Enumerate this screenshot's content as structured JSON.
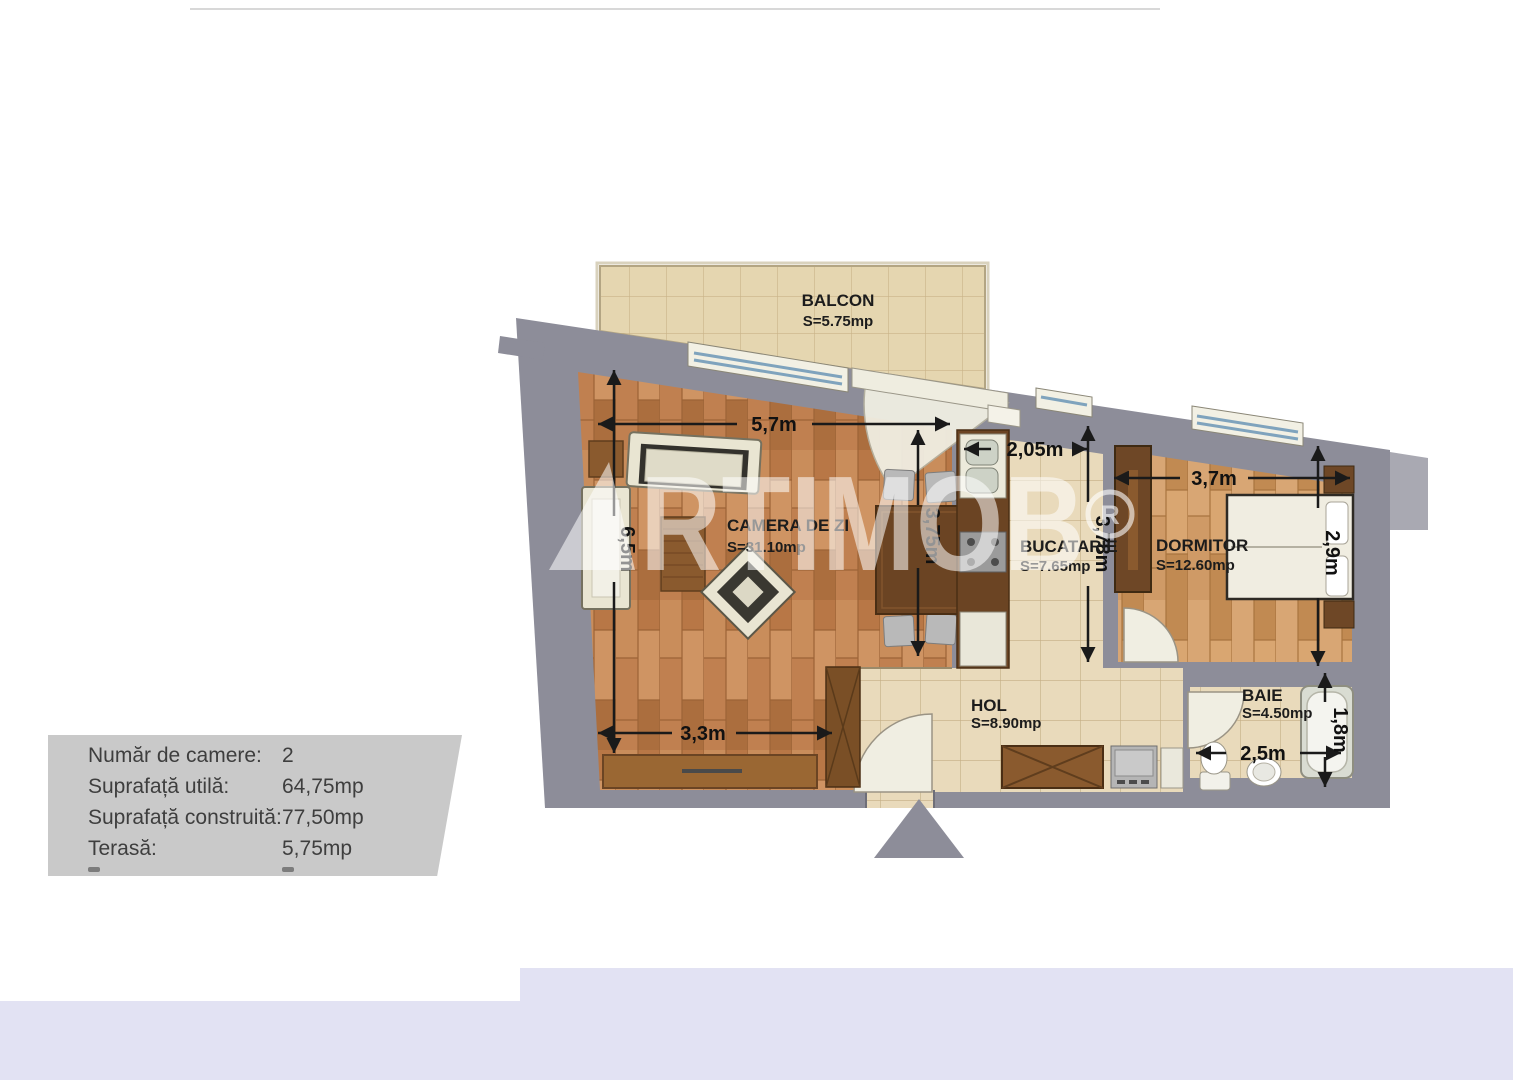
{
  "info_panel": {
    "rows": [
      {
        "label": "Număr de camere:",
        "value": "2"
      },
      {
        "label": "Suprafață utilă:",
        "value": "64,75mp"
      },
      {
        "label": "Suprafață construită:",
        "value": "77,50mp"
      },
      {
        "label": "Terasă:",
        "value": "5,75mp"
      }
    ]
  },
  "rooms": {
    "balcon": {
      "name": "BALCON",
      "area": "S=5.75mp"
    },
    "camera_de_zi": {
      "name": "CAMERA DE ZI",
      "area": "S=31.10mp"
    },
    "bucatarie": {
      "name": "BUCATARIE",
      "area": "S=7.65mp"
    },
    "dormitor": {
      "name": "DORMITOR",
      "area": "S=12.60mp"
    },
    "hol": {
      "name": "HOL",
      "area": "S=8.90mp"
    },
    "baie": {
      "name": "BAIE",
      "area": "S=4.50mp"
    }
  },
  "dimensions": {
    "living_width": "5,7m",
    "living_height": "6,5m",
    "living_inner_depth": "3,75m",
    "living_bottom_width": "3,3m",
    "kitchen_width": "2,05m",
    "kitchen_depth": "3,78m",
    "bedroom_width": "3,7m",
    "bedroom_depth": "2,9m",
    "bathroom_width": "2,5m",
    "bathtub_length": "1,8m"
  },
  "watermark": {
    "brand_suffix": "RTIMOB",
    "registered_mark": "R"
  },
  "colors": {
    "wall_gray": "#8d8d99",
    "parquet_brown": "#c08050",
    "tile_beige": "#e9dabb",
    "panel_gray": "#c9c9c9",
    "bottom_strip_lavender": "#e2e2f3"
  }
}
